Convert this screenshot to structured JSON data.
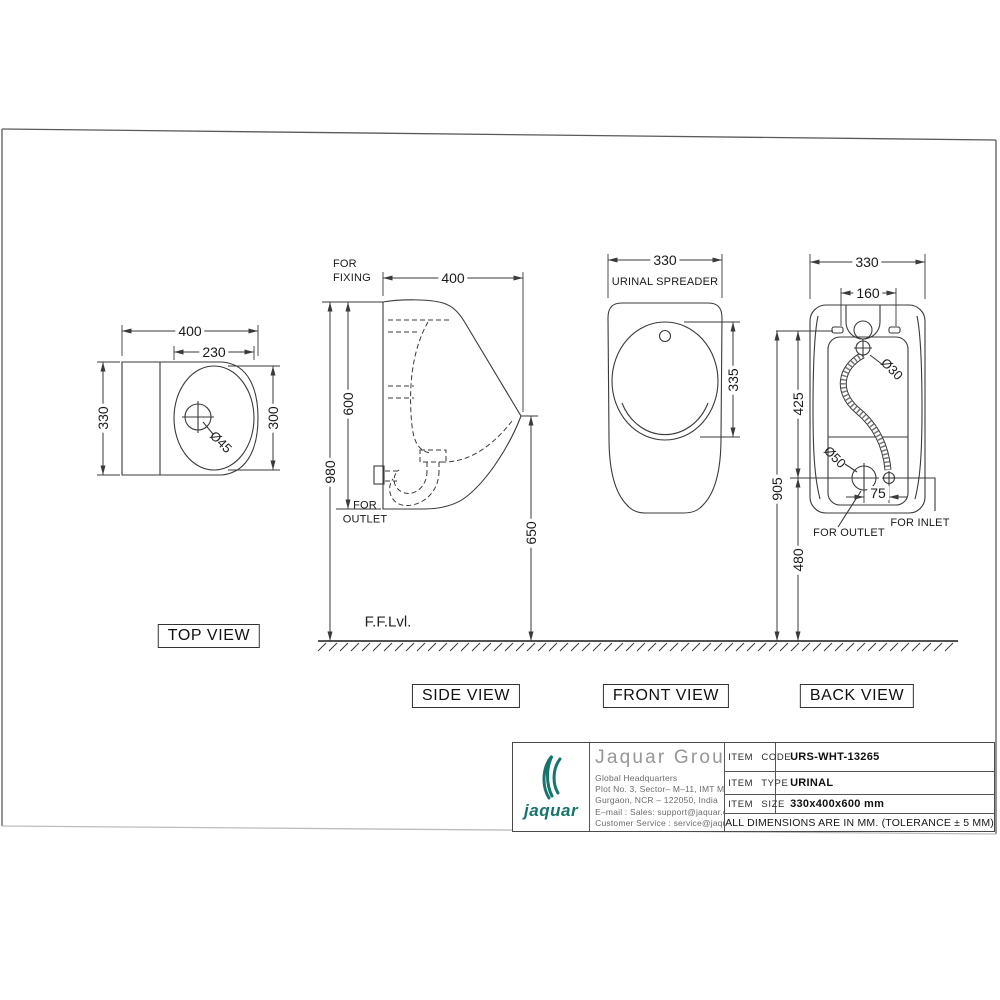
{
  "page": {
    "floor_label": "F.F.Lvl."
  },
  "views": {
    "top": {
      "label": "TOP VIEW",
      "dim_width": "400",
      "dim_inner_width": "230",
      "dim_depth": "330",
      "dim_basin_depth": "300",
      "dim_drain": "Ø45"
    },
    "side": {
      "label": "SIDE VIEW",
      "dim_depth": "400",
      "dim_body_height": "600",
      "dim_fixing_height": "980",
      "dim_spout_height": "650",
      "note_fixing": "FOR FIXING",
      "note_outlet": "FOR OUTLET"
    },
    "front": {
      "label": "FRONT VIEW",
      "dim_width": "330",
      "dim_bowl_height": "335",
      "note_spreader": "URINAL SPREADER"
    },
    "back": {
      "label": "BACK VIEW",
      "dim_width": "330",
      "dim_holes_span": "160",
      "dim_inlet_dia": "Ø30",
      "dim_outlet_dia": "Ø50",
      "dim_fix_to_outlet": "425",
      "dim_fix_height": "905",
      "dim_outlet_offset": "75",
      "dim_outlet_to_floor": "480",
      "note_outlet": "FOR OUTLET",
      "note_inlet": "FOR INLET"
    }
  },
  "title_block": {
    "brand": {
      "wordmark": "jaquar",
      "company": "Jaquar Group",
      "line1": "Global Headquarters",
      "line2": "Plot No. 3, Sector– M–11, IMT Manesar",
      "line3": "Gurgaon, NCR – 122050, India",
      "line4": "E–mail : Sales: support@jaquar.com",
      "line5": "Customer Service : service@jaquar.com",
      "accent_color": "#15756b"
    },
    "fields": [
      {
        "label": "ITEM CODE",
        "value": "URS-WHT-13265"
      },
      {
        "label": "ITEM TYPE",
        "value": "URINAL"
      },
      {
        "label": "ITEM SIZE",
        "value": "330x400x600 mm"
      }
    ],
    "note": "ALL DIMENSIONS ARE IN MM. (TOLERANCE ± 5 MM)"
  }
}
